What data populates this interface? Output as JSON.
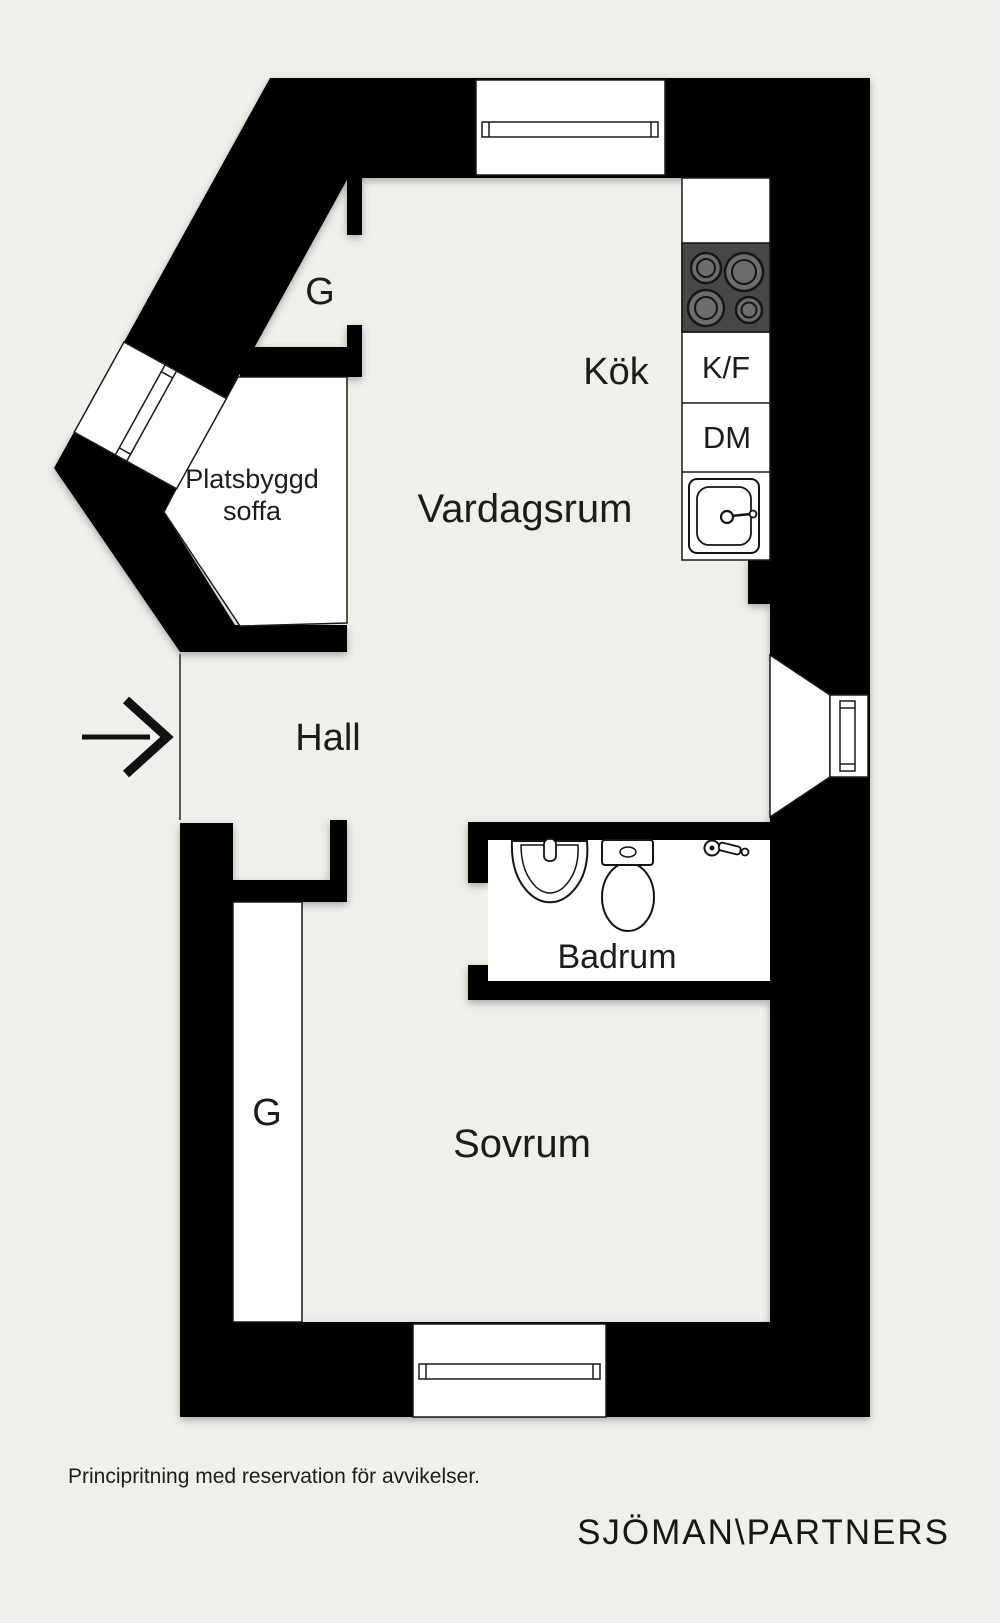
{
  "floor_plan": {
    "rooms": {
      "kitchen": "Kök",
      "living_room": "Vardagsrum",
      "hall": "Hall",
      "bathroom": "Badrum",
      "bedroom": "Sovrum"
    },
    "fixtures": {
      "fridge_freezer": "K/F",
      "dishwasher": "DM",
      "wardrobe_top": "G",
      "wardrobe_bottom": "G",
      "built_in_sofa_line1": "Platsbyggd",
      "built_in_sofa_line2": "soffa"
    },
    "colors": {
      "background": "#f0efe9",
      "wall": "#000000",
      "furniture_white": "#ffffff",
      "stove_body": "#474747",
      "burner_gray": "#6d6d6d",
      "line": "#1a1a1a",
      "text": "#1c1c1c"
    }
  },
  "footer": {
    "disclaimer": "Principritning med reservation för avvikelser.",
    "brand": "SJÖMAN\\PARTNERS"
  }
}
